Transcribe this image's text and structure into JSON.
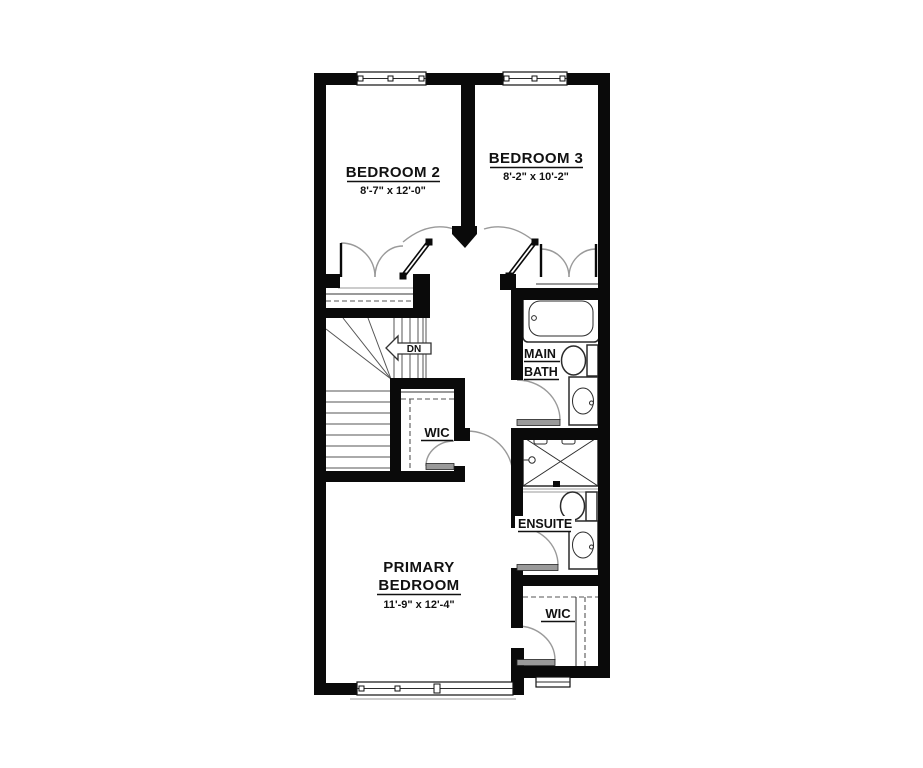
{
  "plan": {
    "rooms": {
      "bedroom2": {
        "name": "BEDROOM 2",
        "dims": "8'-7\" x 12'-0\""
      },
      "bedroom3": {
        "name": "BEDROOM 3",
        "dims": "8'-2\" x 10'-2\""
      },
      "primary": {
        "name_line1": "PRIMARY",
        "name_line2": "BEDROOM",
        "dims": "11'-9\" x 12'-4\""
      },
      "main_bath": {
        "name_line1": "MAIN",
        "name_line2": "BATH"
      },
      "ensuite": {
        "name": "ENSUITE"
      },
      "wic_upper": {
        "name": "WIC"
      },
      "wic_lower": {
        "name": "WIC"
      }
    },
    "stairs": {
      "direction_label": "DN"
    },
    "colors": {
      "wall": "#0a0a0a",
      "background": "#ffffff",
      "fixture_line": "#2b2b2b",
      "swing_arc": "#9a9a9a",
      "door_leaf_fill": "#9a9a9a"
    }
  }
}
